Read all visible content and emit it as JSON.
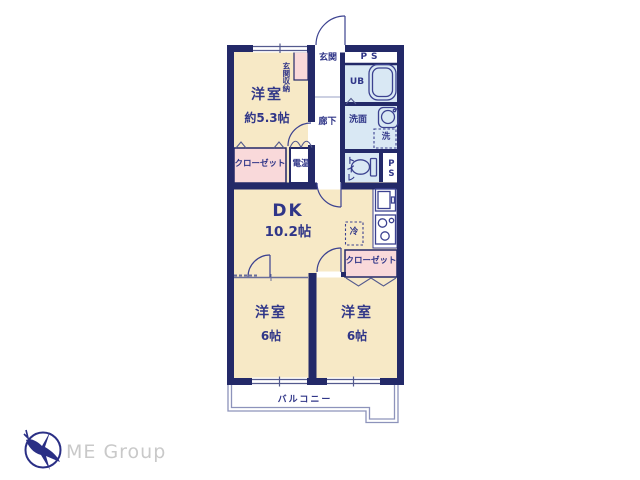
{
  "plan": {
    "rooms": {
      "western_53": {
        "label": "洋室",
        "size": "約5.3帖"
      },
      "entrance": {
        "label": "玄関"
      },
      "entrance_storage": {
        "label": "玄関収納"
      },
      "ps_top": {
        "label": "PS"
      },
      "unit_bath": {
        "label": "UB"
      },
      "washroom": {
        "label": "洗面"
      },
      "washer": {
        "label": "洗"
      },
      "hallway": {
        "label": "廊下"
      },
      "closet_west": {
        "label": "クローゼット"
      },
      "water_heater": {
        "label": "電温"
      },
      "toilet": {
        "label": "トイレ"
      },
      "ps_side": {
        "label": "PS"
      },
      "dining_kitchen": {
        "label": "DK",
        "size": "10.2帖"
      },
      "fridge": {
        "label": "冷"
      },
      "closet_east": {
        "label": "クローゼット"
      },
      "western_bl": {
        "label": "洋室",
        "size": "6帖"
      },
      "western_br": {
        "label": "洋室",
        "size": "6帖"
      },
      "balcony": {
        "label": "バルコニー"
      }
    },
    "colors": {
      "wall": "#232968",
      "room_cream": "#f7e9c6",
      "closet_pink": "#f9d9da",
      "wet_blue": "#d9e8f4",
      "thin_line": "#8d93bb",
      "label_text": "#303688"
    }
  },
  "logo": {
    "company": "ME Group",
    "mark": "bird-in-circle",
    "mark_color": "#2a2f85",
    "text_color": "#c9c9c9"
  }
}
